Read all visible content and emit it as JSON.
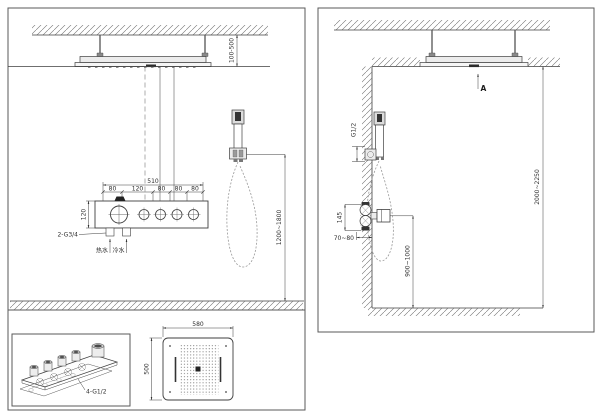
{
  "left_view": {
    "ceiling_gap": "100-500",
    "valve_width_total": "510",
    "segments": [
      "80",
      "120",
      "80",
      "80",
      "80"
    ],
    "valve_height": "120",
    "inlet_spec": "2-G3/4",
    "hot_water_label": "热水",
    "cold_water_label": "冷水",
    "valve_mount_height": "1200~1800"
  },
  "right_view": {
    "section_marker": "A",
    "handshower_thread": "G1/2",
    "valve_body_height": "145",
    "embed_depth": "70~80",
    "valve_height_from_floor": "900~1000",
    "install_height": "2000~2250"
  },
  "detail_view": {
    "outlets_spec": "4-G1/2"
  },
  "plan_view": {
    "head_width": "580",
    "head_depth": "500"
  }
}
